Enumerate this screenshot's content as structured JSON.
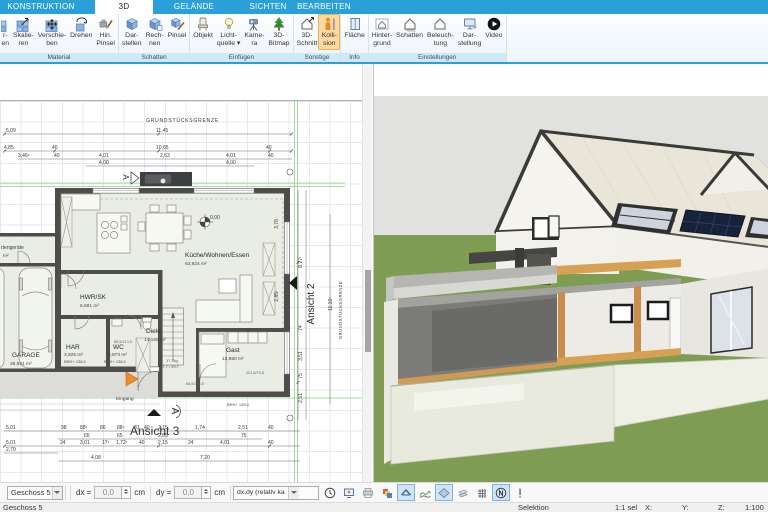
{
  "ribbon": {
    "tabs": [
      {
        "label": "KONSTRUKTION"
      },
      {
        "label": "3D"
      },
      {
        "label": "GELÄNDE"
      },
      {
        "label": "SICHTEN"
      },
      {
        "label": "BEARBEITEN"
      }
    ],
    "groups": [
      {
        "name": "Material",
        "buttons": [
          {
            "l1": "r-",
            "l2": "en"
          },
          {
            "l1": "Skalie-",
            "l2": "ren"
          },
          {
            "l1": "Verschie-",
            "l2": "ben"
          },
          {
            "l1": "Drehen",
            "l2": ""
          },
          {
            "l1": "Hin.",
            "l2": "Pinsel"
          }
        ]
      },
      {
        "name": "Schatten",
        "buttons": [
          {
            "l1": "Dar-",
            "l2": "stellen"
          },
          {
            "l1": "Rech-",
            "l2": "nen"
          },
          {
            "l1": "Pinsel",
            "l2": ""
          }
        ]
      },
      {
        "name": "Einfügen",
        "buttons": [
          {
            "l1": "Objekt",
            "l2": ""
          },
          {
            "l1": "Licht-",
            "l2": "quelle ▾"
          },
          {
            "l1": "Kame-",
            "l2": "ra"
          },
          {
            "l1": "3D-",
            "l2": "Bitmap"
          }
        ]
      },
      {
        "name": "Sonstige",
        "buttons": [
          {
            "l1": "3D-",
            "l2": "Schnitt"
          },
          {
            "l1": "Kolli-",
            "l2": "sion"
          }
        ]
      },
      {
        "name": "Info",
        "buttons": [
          {
            "l1": "Fläche",
            "l2": ""
          }
        ]
      },
      {
        "name": "Einstellungen",
        "buttons": [
          {
            "l1": "Hinter-",
            "l2": "grund"
          },
          {
            "l1": "Schatten",
            "l2": ""
          },
          {
            "l1": "Beleuch-",
            "l2": "tung"
          },
          {
            "l1": "Dar-",
            "l2": "stellung"
          },
          {
            "l1": "Video",
            "l2": ""
          }
        ]
      }
    ]
  },
  "plan": {
    "boundary_top": "GRUNDSTÜCKSGRENZE",
    "boundary_right": "GRUNDSTÜCKSGRENZE",
    "rooms": {
      "kueche": {
        "name": "Küche/Wohnen/Essen",
        "area": "63,924 m²"
      },
      "hwr": {
        "name": "HWR/SK",
        "area": "6,681 m²"
      },
      "har": {
        "name": "HAR",
        "area": "3,925 m²"
      },
      "wc": {
        "name": "WC",
        "area": "3,873 m²"
      },
      "diele": {
        "name": "Diele",
        "area": "14,169 m²"
      },
      "gast": {
        "name": "Gast",
        "area": "13,850 m²"
      },
      "garage": {
        "name": "GARAGE",
        "area": "26,931 m²"
      },
      "geraete": {
        "name": "rtengeräte",
        "area": "m²"
      }
    },
    "marks": {
      "eingang": "Eingang",
      "level": "0,00",
      "stairs1": "17 Stg.",
      "stairs2": "17,7 / 29,7",
      "brh138": "BRH+ 138,0",
      "brh128": "BRH+ 128,0",
      "ansicht2": "Ansicht 2",
      "ansicht3": "Ansicht 3",
      "view_a": "A",
      "door1": "88,5/213,5",
      "door2": "88,5/213,5",
      "door3": "201,8/75,8"
    },
    "dims": {
      "top1": [
        "5,09",
        "11,45"
      ],
      "top2": [
        "4,85",
        "40",
        "10,65",
        "40"
      ],
      "top3": [
        "3,46¹",
        "40",
        "4,01",
        "2,63",
        "4,01",
        "40"
      ],
      "top4": [
        "4,00",
        "4,00"
      ],
      "bot1": [
        "5,01",
        "98",
        "88¹",
        "86",
        "88¹",
        "81",
        "40",
        "2,15",
        "1,74",
        "2,51",
        "40"
      ],
      "bot2": [
        "65",
        "65",
        "2,85",
        "75"
      ],
      "bot3": [
        "5,01",
        "24",
        "3,01",
        "17¹",
        "1,72¹",
        "40",
        "2,15",
        "24",
        "4,01",
        "40"
      ],
      "bot4": [
        "2,70"
      ],
      "bot5": [
        "4,08",
        "7,20"
      ],
      "right": [
        "3,76",
        "2,85¹",
        "8,27¹",
        "11,16¹",
        "74",
        "3,51",
        "75",
        "2,51"
      ]
    }
  },
  "toolbar": {
    "floor": "Geschoss 5",
    "dx_label": "dx =",
    "dx_value": "0,0",
    "dy_label": "dy =",
    "dy_value": "0,0",
    "unit": "cm",
    "mode": "dx,dy (relativ ka"
  },
  "statusbar": {
    "floor": "Geschoss 5",
    "selection": "Selektion",
    "sel_ratio": "1:1 sel",
    "x_label": "X:",
    "y_label": "Y:",
    "z_label": "Z:",
    "scale": "1:100"
  },
  "colors": {
    "accent_blue": "#2aa0d8",
    "highlight_orange": "#fcd9a2",
    "ground_green": "#7e9d52",
    "roof_cream": "#eae7da",
    "sky_gray": "#e1e1df"
  }
}
